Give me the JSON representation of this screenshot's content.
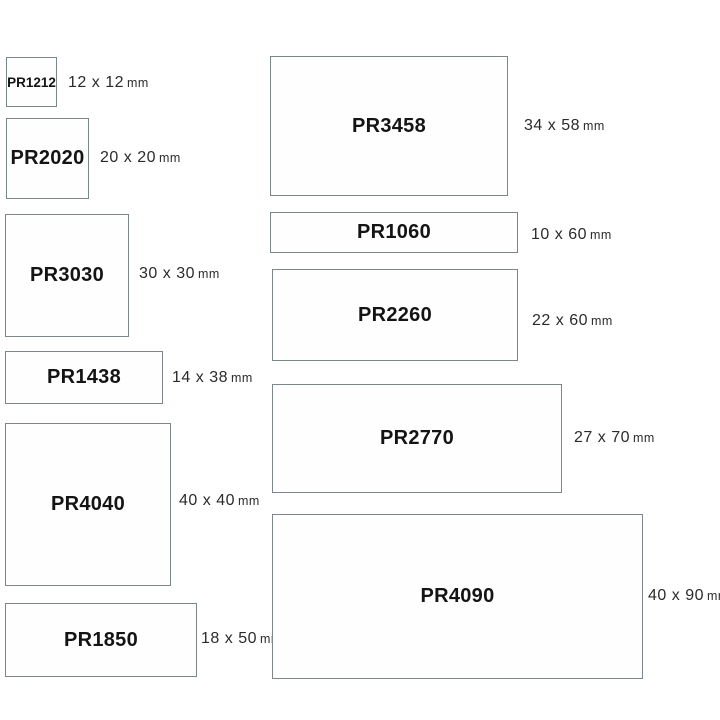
{
  "colors": {
    "background": "#ffffff",
    "border": "#7c8688",
    "code-text": "#141414",
    "dim-text": "#2b2b2b"
  },
  "items": [
    {
      "code": "PR1212",
      "dims": "12 x 12",
      "unit": "mm"
    },
    {
      "code": "PR2020",
      "dims": "20 x 20",
      "unit": "mm"
    },
    {
      "code": "PR3030",
      "dims": "30 x 30",
      "unit": "mm"
    },
    {
      "code": "PR1438",
      "dims": "14 x 38",
      "unit": "mm"
    },
    {
      "code": "PR4040",
      "dims": "40 x 40",
      "unit": "mm"
    },
    {
      "code": "PR1850",
      "dims": "18 x 50",
      "unit": "mm"
    },
    {
      "code": "PR3458",
      "dims": "34 x 58",
      "unit": "mm"
    },
    {
      "code": "PR1060",
      "dims": "10 x 60",
      "unit": "mm"
    },
    {
      "code": "PR2260",
      "dims": "22 x 60",
      "unit": "mm"
    },
    {
      "code": "PR2770",
      "dims": "27 x 70",
      "unit": "mm"
    },
    {
      "code": "PR4090",
      "dims": "40 x 90",
      "unit": "mm"
    }
  ]
}
